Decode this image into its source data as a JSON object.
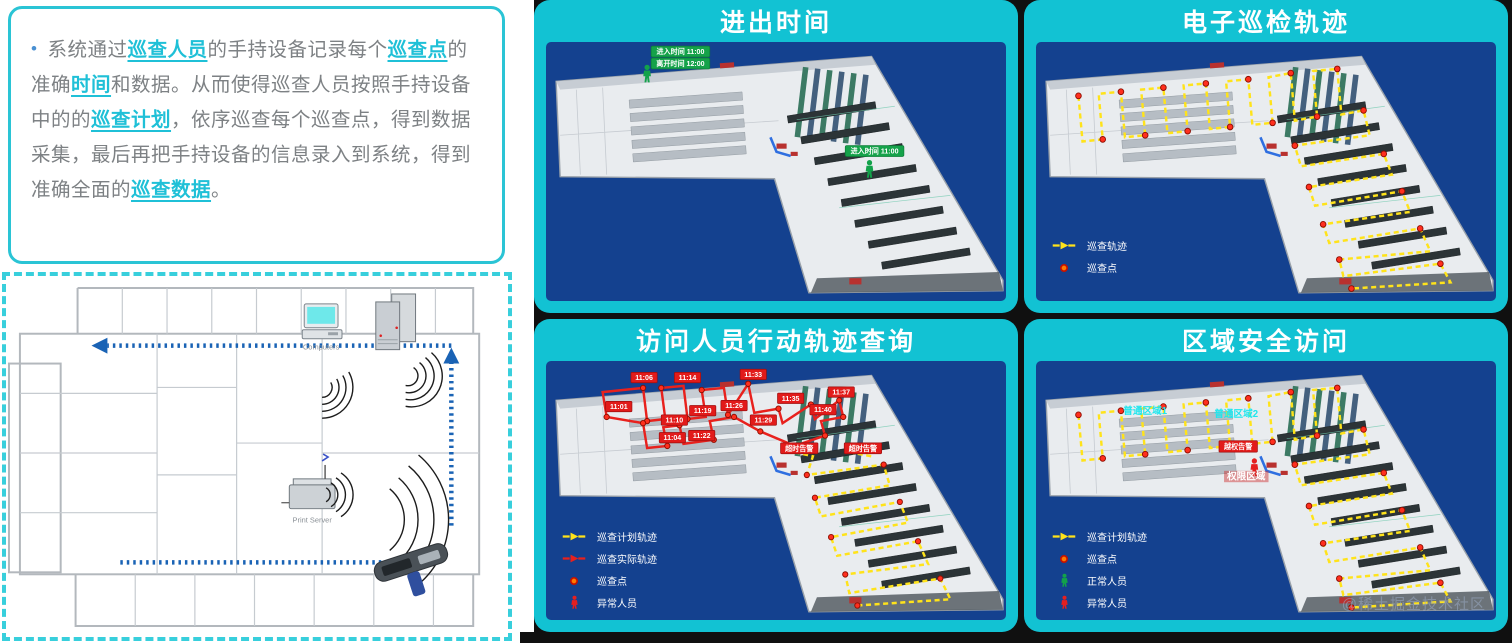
{
  "intro": {
    "bullet": "•",
    "segments": [
      {
        "t": "系统通过"
      },
      {
        "t": "巡查人员"
      },
      {
        "t": "的手持设备记录每个"
      },
      {
        "t": "巡查点"
      },
      {
        "t": "的准确"
      },
      {
        "t": "时间"
      },
      {
        "t": "和数据。从而使得巡查人员按照手持设备中的的"
      },
      {
        "t": "巡查计划"
      },
      {
        "t": "，依序巡查每个巡查点，得到数据采集，最后再把手持设备的信息录入到系统，得到准确全面的"
      },
      {
        "t": "巡查数据"
      },
      {
        "t": "。"
      }
    ]
  },
  "floorplan": {
    "computers_label": "Computers",
    "server_label": "Print Server"
  },
  "panels": {
    "entry_exit": {
      "title": "进出时间",
      "tag_enter_1": "进入时间 11:00",
      "tag_leave_1": "离开时间 12:00",
      "tag_enter_2": "进入时间 11:00"
    },
    "patrol_track": {
      "title": "电子巡检轨迹",
      "legend_track": "巡查轨迹",
      "legend_point": "巡查点"
    },
    "visitor_track": {
      "title": "访问人员行动轨迹查询",
      "times": [
        "11:01",
        "11:06",
        "11:10",
        "11:04",
        "11:14",
        "11:19",
        "11:22",
        "11:26",
        "11:29",
        "11:33",
        "11:35",
        "11:37",
        "11:40"
      ],
      "alarm_1": "超时告警",
      "alarm_2": "超时告警",
      "legend_plan": "巡查计划轨迹",
      "legend_actual": "巡查实际轨迹",
      "legend_point": "巡查点",
      "legend_abnormal": "异常人员"
    },
    "area_access": {
      "title": "区域安全访问",
      "area_label_1": "普通区域1",
      "area_label_2": "普通区域2",
      "alarm": "越权告警",
      "zone_label": "权限区域",
      "legend_plan": "巡查计划轨迹",
      "legend_point": "巡查点",
      "legend_normal": "正常人员",
      "legend_abnormal": "异常人员"
    }
  },
  "watermark": "@稀土掘金技术社区",
  "colors": {
    "accent": "#12c2d3",
    "map_bg": "#14418f",
    "route_plan": "#ffe31a",
    "route_actual": "#e8211d",
    "alarm_red": "#e21b1a",
    "ok_green": "#15a24a",
    "highlight": "#1fc0d7"
  }
}
